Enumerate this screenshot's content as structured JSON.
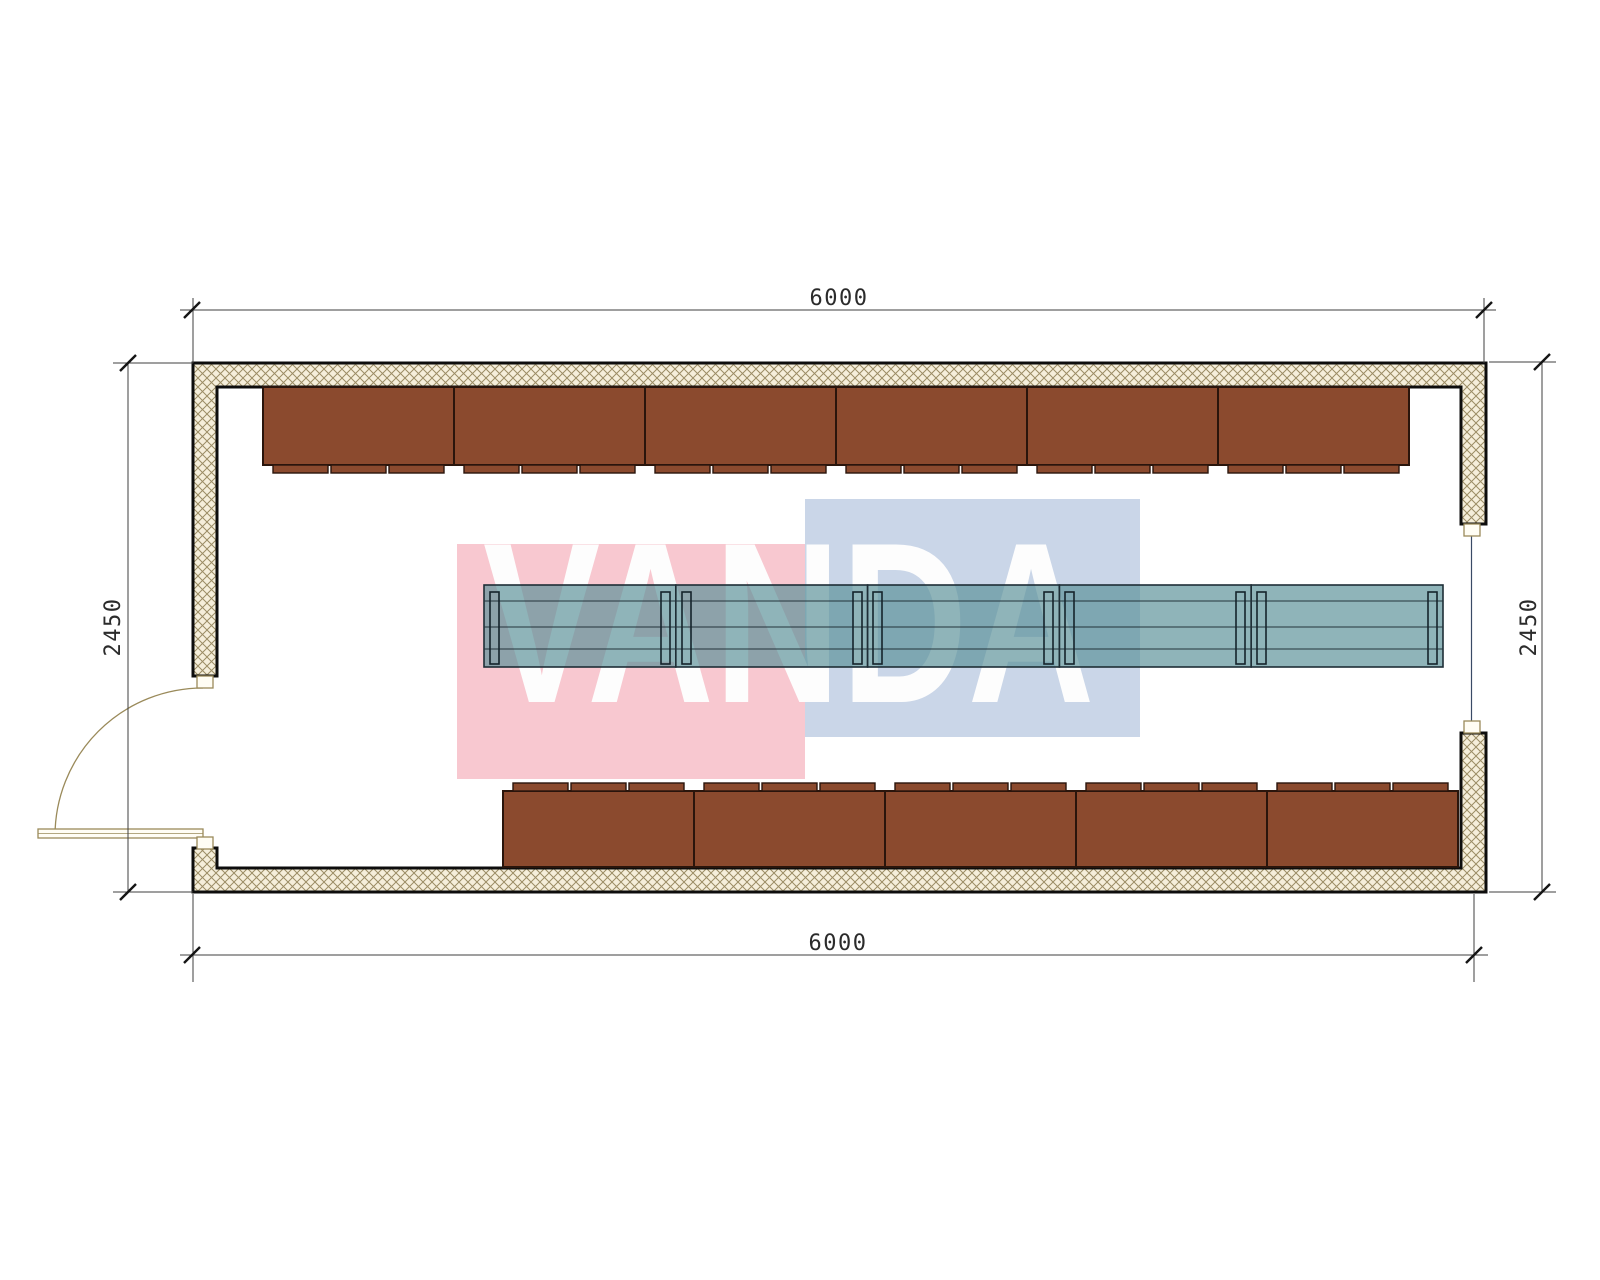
{
  "watermark": {
    "text": "VANDA",
    "pink_color": "#f8c8d0",
    "blue_color": "#cad6e8",
    "text_color": "#fdfdfd"
  },
  "dimensions": {
    "top": "6000",
    "bottom": "6000",
    "left": "2450",
    "right": "2450"
  },
  "plan": {
    "bench_color": "#8b4a2e",
    "bench_outline": "#2a150c",
    "table_fill": "rgba(90,145,152,0.68)",
    "wall_hatch_bg": "#f5eeda",
    "wall_hatch_line": "#9b8c64",
    "wall_outline": "#0d0d0d",
    "door_color": "#9a8a5a",
    "top_bench_count": 6,
    "bottom_bench_count": 5,
    "table_segment_count": 5
  }
}
